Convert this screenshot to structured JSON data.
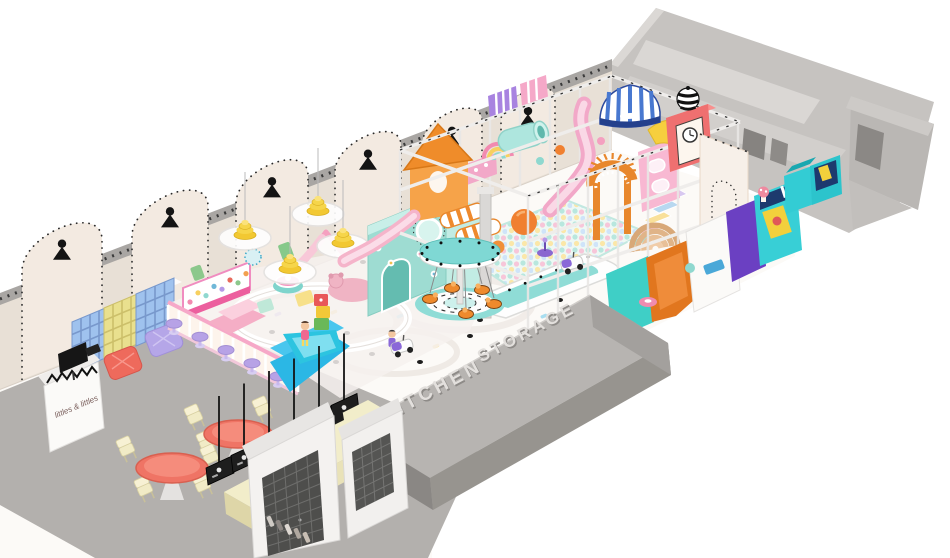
{
  "scene": {
    "title": "Indoor kids playground 3D floor-plan render",
    "labels": {
      "kitchen": "KITCHEN",
      "storage": "STORAGE",
      "reception_sign": "littles & littles"
    },
    "palette": {
      "wall": "#e8e0d6",
      "wall_arch": "#f3eae1",
      "wall_trim": "#a9a6a3",
      "floor": "#fcfaf7",
      "cafe_floor": "#b3b0ad",
      "roof_slab": "#b7b4b1",
      "roof_slab_front": "#97948f",
      "roof_text": "#e3e0dd",
      "roof_text_shadow": "#8e8b88",
      "gray_rooms": "#c6c3c0",
      "gray_room_floor": "#d8d5d2",
      "doorway": "#868380",
      "mint": "#9edcd2",
      "teal": "#3fcfc6",
      "cyan": "#2bb7e5",
      "pink": "#f4a9c7",
      "hot_pink": "#ec5f9e",
      "orange": "#ee8a2d",
      "yellow": "#f2cf3e",
      "lamp_yellow": "#f2c832",
      "purple": "#6b40c2",
      "lavender": "#b7a2e6",
      "red": "#ee6a5c",
      "coral_table": "#ef7465",
      "cream": "#f2edca",
      "chair_cream": "#f1ebc6",
      "blue_shelf": "#9fc2ee",
      "yellow_shelf": "#e9e08e",
      "menu_board": "#1e1e1e",
      "kitchen_tile": "#4e4e4c",
      "navy": "#1d3a6e"
    },
    "objects": [
      "back-wall-arch-niches",
      "wall-sconce-lamps",
      "pendant-beehive-lamps",
      "shoe-cubbies",
      "pouf-ottomans",
      "reception-desk",
      "reception-monitor",
      "toddler-soft-play-zone",
      "busy-board",
      "toddler-fence-with-stools",
      "mini-donut-carousel",
      "teddy-bear-mat",
      "soft-block-stairs",
      "toddler-slide",
      "play-structure-frame",
      "mint-playhouse",
      "orange-tower",
      "roller-cylinders",
      "ball-pit",
      "big-orange-ball",
      "boat-platform",
      "pink-wave-slide",
      "sunburst-arch",
      "pastel-stairs",
      "striped-awning",
      "clock-tower-striped-ball",
      "carousel-ride",
      "ride-on-cars",
      "kitchen-storage-roof-slab",
      "cafe-round-tables",
      "cafe-chairs",
      "menu-boards",
      "coffee-counter",
      "espresso-machine",
      "kitchen-wall-unit",
      "storage-rooms",
      "party-storage-boxes"
    ]
  }
}
